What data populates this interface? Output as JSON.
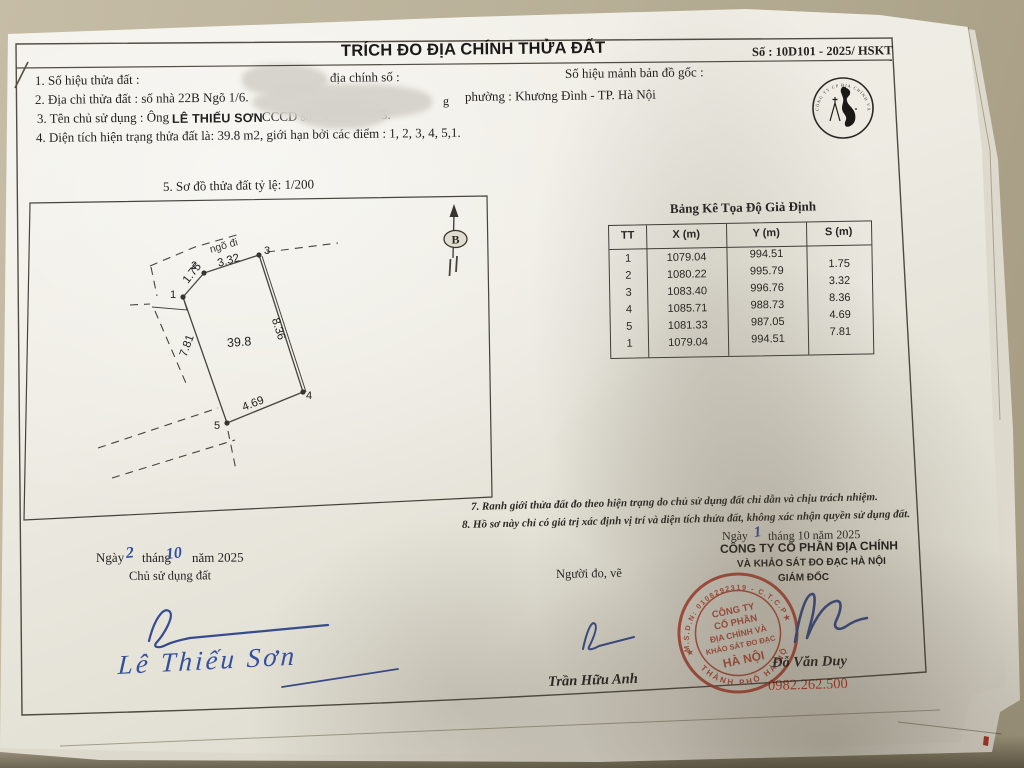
{
  "header": {
    "title": "TRÍCH ĐO ĐỊA CHÍNH THỬA ĐẤT",
    "doc_number": "Số : 10D101 - 2025/ HSKT"
  },
  "fields": {
    "parcel_label": "1. Số hiệu thửa đất :",
    "parcel_mid": "địa chính số :",
    "parcel_right": "Số hiệu mảnh bản đồ gốc :",
    "address_label": "2. Địa chỉ thửa đất : số nhà 22B Ngõ 1/6.",
    "address_frag": "g",
    "address_right": "phường : Khương Đình - TP. Hà Nội",
    "owner_label": "3. Tên chủ sử dụng :  Ông",
    "owner_name": "LÊ THIẾU SƠN",
    "owner_id": "CCCD số : 0",
    "owner_id_frag": "5.",
    "area_line": "4. Diện tích hiện trạng thửa đất là:  39.8 m2, giới hạn bởi các điểm : 1, 2, 3, 4, 5,1."
  },
  "sketch": {
    "caption": "5. Sơ đồ thửa đất tỷ lệ: 1/200",
    "alley": "ngõ đi",
    "area": "39.8",
    "north": "B",
    "edges": {
      "e12": "1.75",
      "e23": "3.32",
      "e34": "8.36",
      "e45": "4.69",
      "e51": "7.81"
    },
    "v1": "1",
    "v2": "2",
    "v3": "3",
    "v4": "4",
    "v5": "5"
  },
  "table": {
    "title": "Bảng Kê Tọa Độ Giả Định",
    "headers": [
      "TT",
      "X (m)",
      "Y (m)",
      "S (m)"
    ],
    "rows": [
      [
        "1",
        "1079.04",
        "994.51"
      ],
      [
        "2",
        "1080.22",
        "995.79"
      ],
      [
        "3",
        "1083.40",
        "996.76"
      ],
      [
        "4",
        "1085.71",
        "988.73"
      ],
      [
        "5",
        "1081.33",
        "987.05"
      ],
      [
        "1",
        "1079.04",
        "994.51"
      ]
    ],
    "s_values": [
      "1.75",
      "3.32",
      "8.36",
      "4.69",
      "7.81"
    ]
  },
  "notes": {
    "n7": "7. Ranh giới thửa đất đo theo hiện trạng do chủ sử dụng đất chỉ dẫn và chịu trách nhiệm.",
    "n8": "8. Hồ sơ này chỉ có giá trị xác định vị trí và diện tích thửa đất, không xác nhận quyền sử dụng đất."
  },
  "signoff": {
    "left_date_pre": "Ngày",
    "left_day": "2",
    "left_month_label": "tháng",
    "left_month": "10",
    "left_year": "năm 2025",
    "owner_role": "Chủ sử dụng đất",
    "owner_signed_name": "Lê Thiếu Sơn",
    "surveyor_role": "Người đo, vẽ",
    "surveyor_name": "Trần Hữu Anh",
    "right_date_pre": "Ngày",
    "right_day": "1",
    "right_date_post": "tháng 10 năm 2025",
    "company_line1": "CÔNG TY CỔ PHẦN ĐỊA CHÍNH",
    "company_line2": "VÀ KHẢO SÁT ĐO ĐẠC HÀ NỘI",
    "director_title": "GIÁM ĐỐC",
    "director_name": "Đỗ Văn Duy",
    "phone": "0982.262.500"
  },
  "stamp": {
    "ring_top": "M.S.D.N: 0108292319 - C.T.C.P",
    "ring_bottom": "THÀNH PHỐ HÀ NỘI",
    "line1": "CÔNG TY",
    "line2": "CỔ PHẦN",
    "line3": "ĐỊA CHÍNH VÀ",
    "line4": "KHẢO SÁT ĐO ĐẠC",
    "line5": "HÀ NỘI",
    "star": "★",
    "color": "#c63f2e"
  },
  "logo": {
    "ring_text": "CÔNG TY CP ĐỊA CHÍNH VÀ KHẢO SÁT ĐO ĐẠC HÀ NỘI ★ ★ ★"
  }
}
